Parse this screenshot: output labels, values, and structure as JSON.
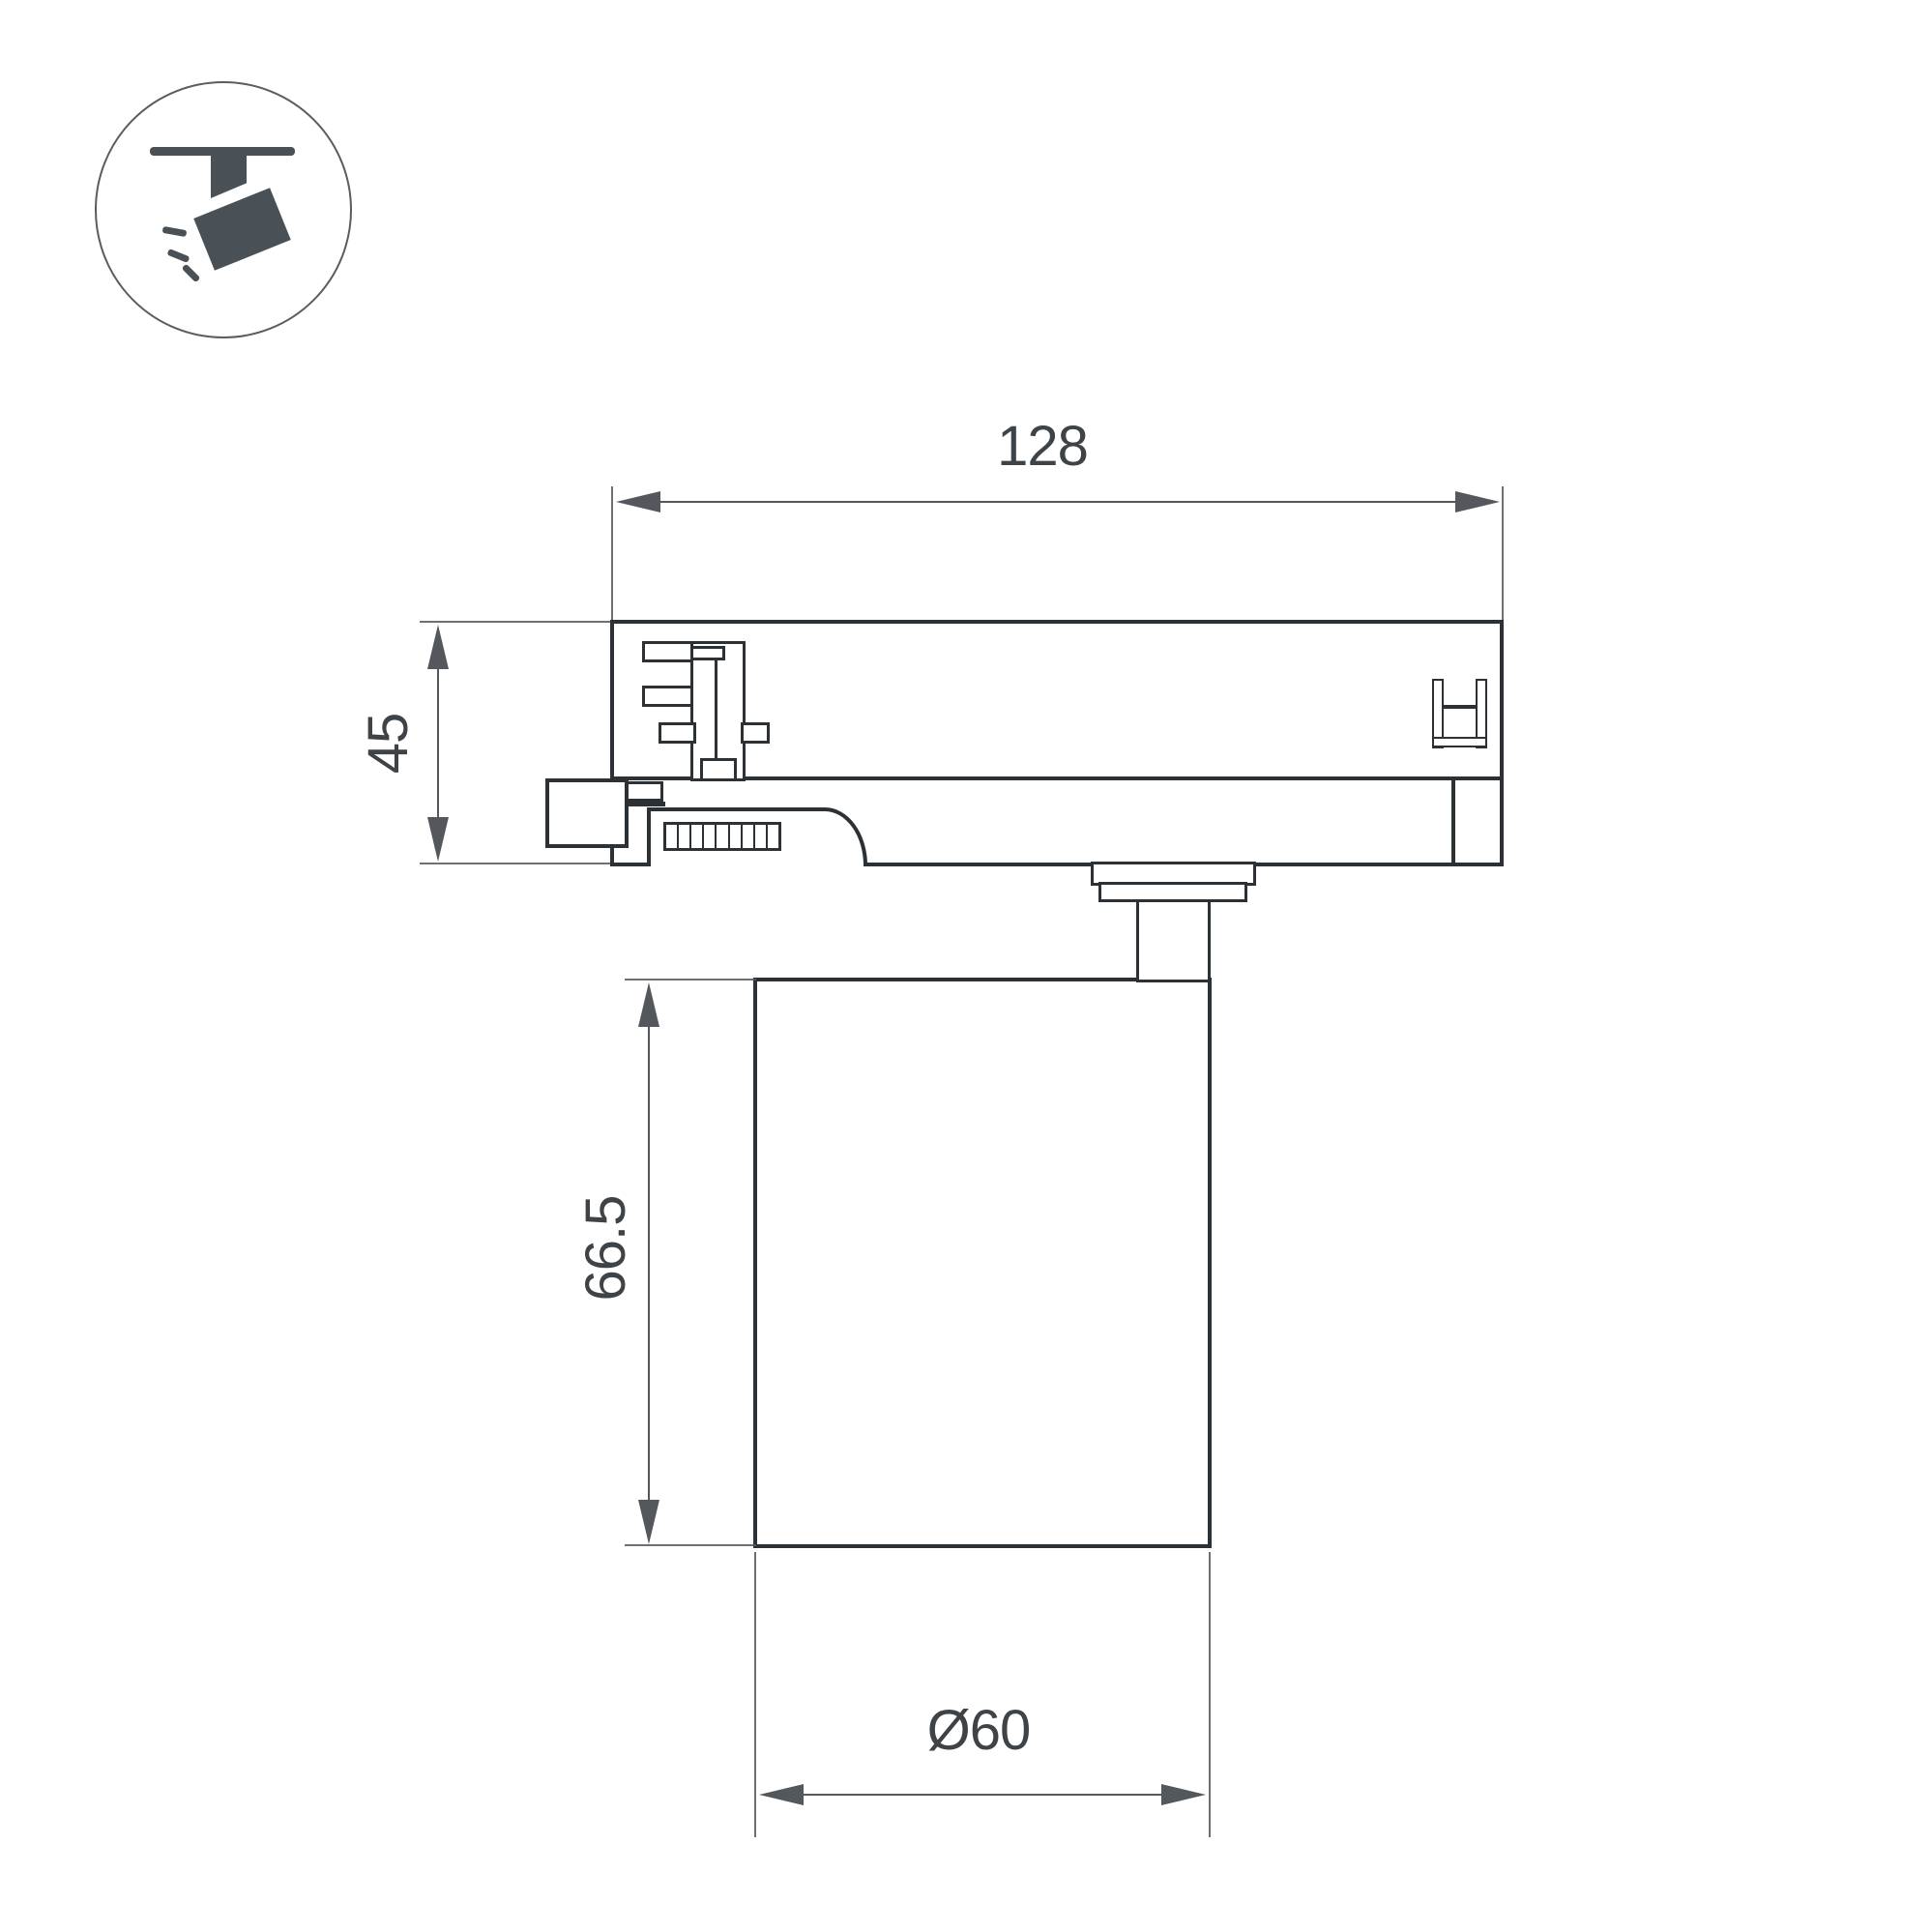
{
  "colors": {
    "background": "#ffffff",
    "line": "#2c3135",
    "dim": "#54585c",
    "text": "#3e4347",
    "icon": "#4a5156",
    "circle": "#585d61"
  },
  "legend": {
    "icon": "track-spotlight"
  },
  "dimensions": {
    "track_width": {
      "value": "128"
    },
    "adapter_height": {
      "value": "45"
    },
    "lamp_height": {
      "value": "66.5"
    },
    "lamp_diameter": {
      "value": "Ø60"
    }
  },
  "adapter": {
    "grille_cells": 9
  }
}
